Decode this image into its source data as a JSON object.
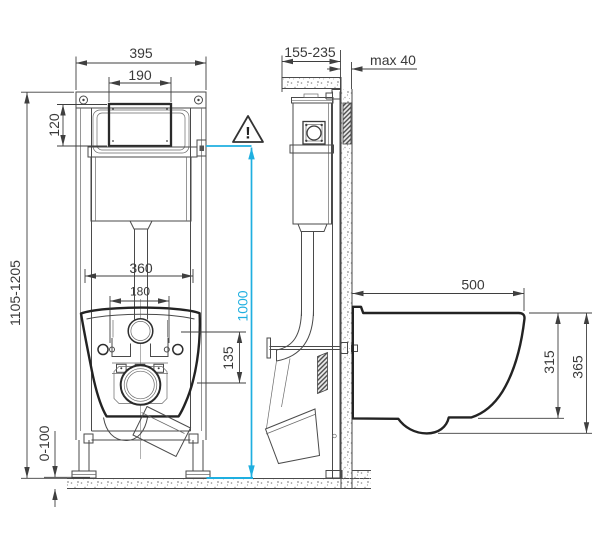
{
  "drawing_type": "wall-hung toilet installation frame, front and side view",
  "dims": {
    "front_overall_width": "395",
    "front_plate_width": "190",
    "front_plate_height": "120",
    "front_height_range": "1105-1205",
    "front_inner_width": "360",
    "front_bolt_spacing": "180",
    "front_outlet_offset": "135",
    "front_foot_range": "0-100",
    "front_actuation_height": "1000",
    "side_depth_range": "155-235",
    "side_finish_max": "max 40",
    "side_bowl_depth": "500",
    "side_bowl_rear_height": "315",
    "side_bowl_total_height": "365"
  },
  "warning": {
    "mark": "!"
  },
  "colors": {
    "accent_cyan": "#1FAFE0",
    "line_dark": "#3F3F3F"
  }
}
